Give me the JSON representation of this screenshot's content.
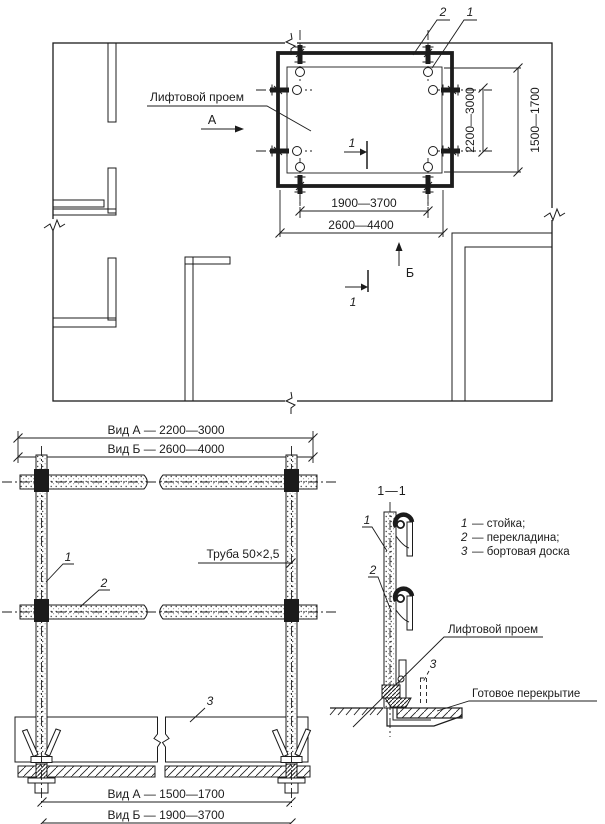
{
  "plan": {
    "callouts": {
      "c1": "1",
      "c2": "2"
    },
    "opening_label": "Лифтовой проем",
    "view_a": "А",
    "view_b": "Б",
    "section_mark": "1",
    "dims": {
      "width_inner": "1900—3700",
      "width_outer": "2600—4400",
      "height_inner": "2200—3000",
      "height_outer": "1500—1700"
    }
  },
  "elevation": {
    "dims": {
      "top_a": "Вид А — 2200—3000",
      "top_b": "Вид Б — 2600—4000",
      "bottom_a": "Вид А — 1500—1700",
      "bottom_b": "Вид Б — 1900—3700"
    },
    "callouts": {
      "c1": "1",
      "c2": "2",
      "c3": "3"
    },
    "pipe_label": "Труба 50×2,5"
  },
  "section": {
    "title": "1—1",
    "callouts": {
      "c1": "1",
      "c2": "2",
      "c3": "3"
    },
    "legend": [
      {
        "num": "1",
        "text": "—  стойка;"
      },
      {
        "num": "2",
        "text": "—  перекладина;"
      },
      {
        "num": "3",
        "text": "—  бортовая доска"
      }
    ],
    "opening_label": "Лифтовой проем",
    "slab_label": "Готовое перекрытие"
  },
  "colors": {
    "ink": "#1c1c1c",
    "paper": "#ffffff"
  }
}
